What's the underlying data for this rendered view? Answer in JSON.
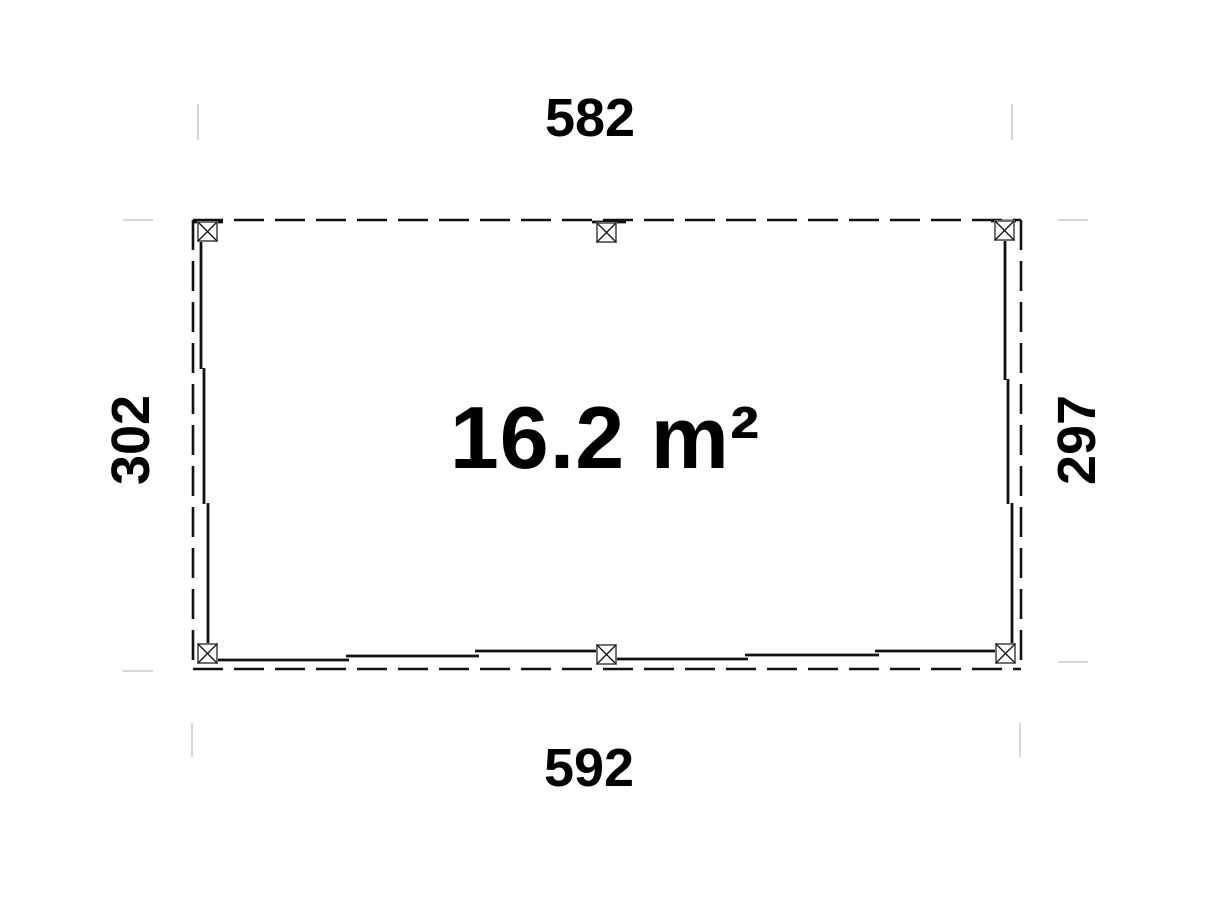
{
  "diagram": {
    "type": "floor-plan",
    "area_label": "16.2 m²",
    "dimensions": {
      "top": "582",
      "bottom": "592",
      "left": "302",
      "right": "297"
    },
    "post_icon": "crossed-square-post",
    "post_count": 6,
    "colors": {
      "background": "#ffffff",
      "wall_line": "#111111",
      "dashed_outline": "#111111",
      "extension_line": "#cbcbcb",
      "post_outline": "#707070",
      "text": "#000000"
    }
  }
}
